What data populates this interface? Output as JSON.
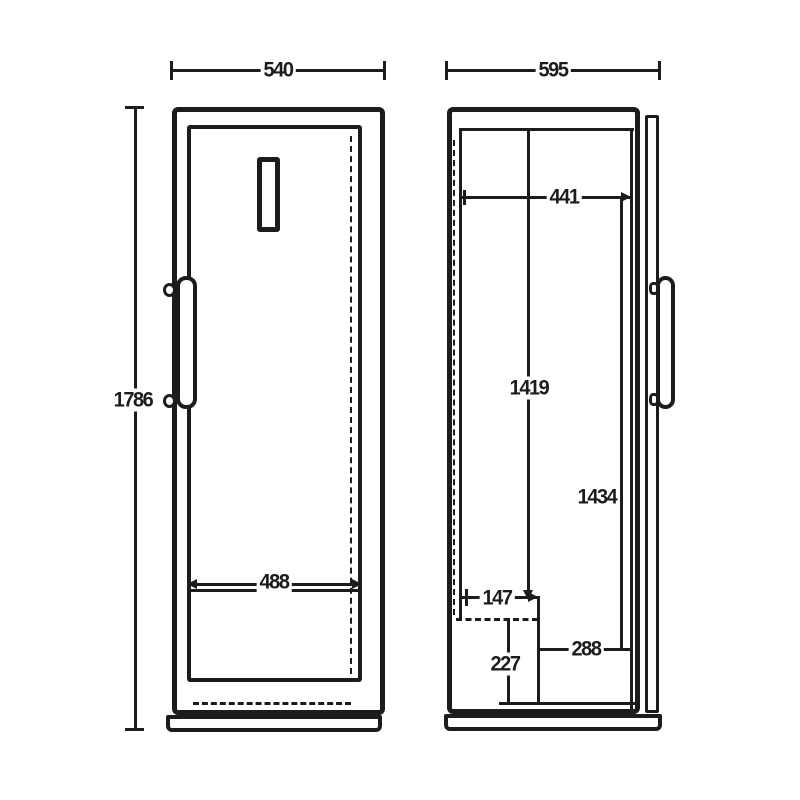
{
  "meta": {
    "drawing_type": "appliance dimension drawing, front and side view",
    "background_color": "#ffffff",
    "line_color": "#1c1c1c"
  },
  "front_view": {
    "width": "540",
    "height": "1786",
    "door_width": "488"
  },
  "side_view": {
    "depth": "595",
    "top_offset": "441",
    "mid_height": "1419",
    "lower_height": "1434",
    "recess_depth": "147",
    "recess_width": "288",
    "recess_height": "227"
  }
}
